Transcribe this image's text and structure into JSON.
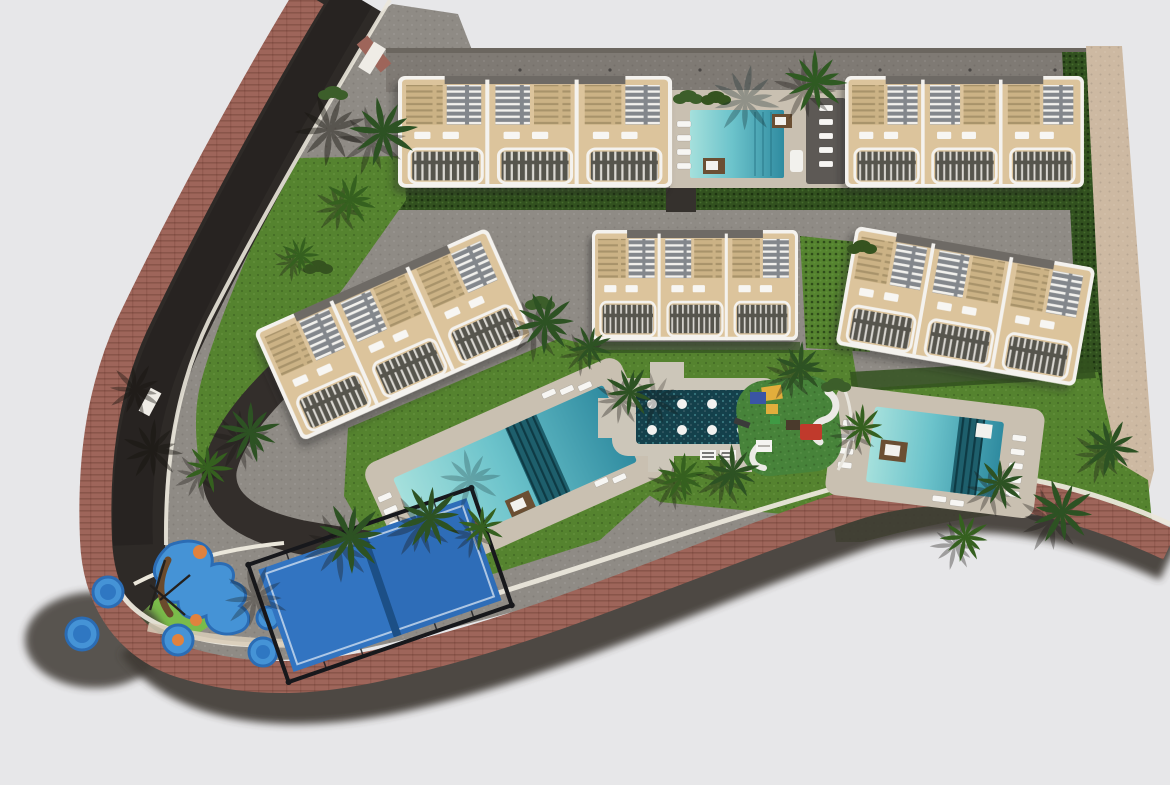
{
  "meta": {
    "type": "aerial-3d-render",
    "subject": "residential-complex-site-plan"
  },
  "palette": {
    "background": "#e7e7e9",
    "asphalt": "#2e2a27",
    "brick_sidewalk": "#9e655a",
    "curb_white": "#ebe7db",
    "paving": "#8f8b85",
    "parking_band": "#7f7a74",
    "parking_edge": "#6b665f",
    "plaza_concrete": "#ccc6b9",
    "deck": "#c9c0b1",
    "deck_dark": "#5d5955",
    "lawn": "#55832f",
    "lawn_bright": "#7abb4a",
    "groundcover": "#8cc268",
    "hedge": "#32511f",
    "palm_green": "#2d5223",
    "palm_shadow": "#17140f",
    "dirt_path": "#cdb9a2",
    "pool_steps": "#1e5f6c",
    "building_white": "#f4f2ee",
    "building_beige": "#dcc49c",
    "pergola_gray": "#83878c",
    "balcony_dark": "#57544d",
    "roof_gray": "#6e6a65",
    "lounger_white": "#f7f6f3",
    "daybed_brown": "#6b4f33",
    "court_blue": "#2e6db8",
    "court_blue_light": "#3577c4",
    "court_frame": "#17181c",
    "splash_blue": "#4593d6",
    "splash_border": "#2b6cb4",
    "splash_orange": "#e0823e",
    "play_red": "#c03a2c",
    "play_yellow": "#e2ae3c",
    "play_blue": "#3a55a5",
    "play_rubber": "#47833a",
    "plaza_feature": "#14404b",
    "driveway": "#332e2b",
    "shadow": "#3f3a36",
    "gate_white": "#efece6"
  },
  "features": {
    "buildings": [
      "north-west-block",
      "north-east-block",
      "west-block",
      "center-block",
      "east-block"
    ],
    "pools": [
      "north-pool",
      "west-pool",
      "east-pool"
    ],
    "amenities": [
      "paddle-tennis-court",
      "children-splash-area",
      "playground",
      "community-plaza"
    ],
    "landscape": [
      "palm-trees",
      "lawns",
      "hedges"
    ],
    "circulation": [
      "perimeter-road",
      "brick-sidewalk",
      "internal-driveway",
      "parking-band"
    ]
  }
}
